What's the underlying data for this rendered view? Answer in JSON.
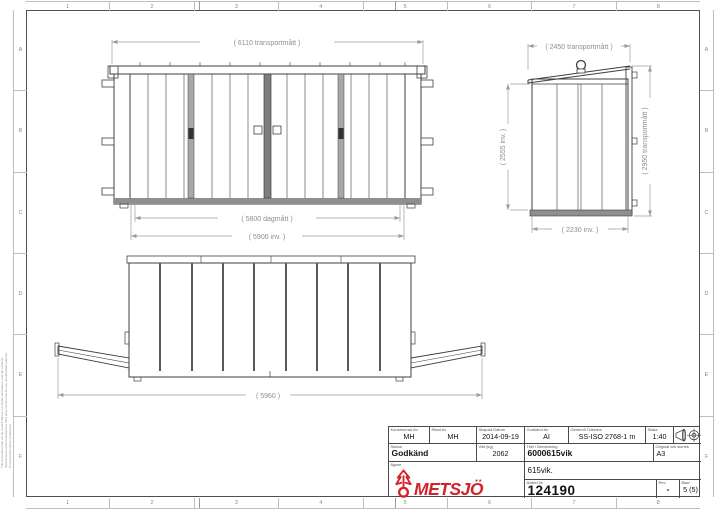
{
  "sheet": {
    "columns": [
      "1",
      "2",
      "3",
      "4",
      "5",
      "6",
      "7",
      "8"
    ],
    "rows": [
      "A",
      "B",
      "C",
      "D",
      "E",
      "F"
    ],
    "legal_notice": "This document must not be copied without our written permission, and the contents thereof must not be imparted to a third party nor be used for any unauthorized purpose. Contravention will be prosecuted."
  },
  "views": {
    "front": {
      "dim_transport": "( 6110 transportmått )",
      "dim_opening": "( 5800 dagmått )",
      "dim_inner": "( 5900 inv. )"
    },
    "side": {
      "dim_transport_width": "( 2450 transportmått )",
      "dim_inner_height": "( 2555 inv. )",
      "dim_transport_height": "( 2950 transportmått )",
      "dim_inner_width": "( 2230 inv. )"
    },
    "plan": {
      "dim_length": "( 5960 )"
    }
  },
  "title_block": {
    "designed_by": {
      "label": "Konstruerad Av",
      "value": "MH"
    },
    "drawn_by": {
      "label": "Ritad Av",
      "value": "MH"
    },
    "created_date": {
      "label": "Skapad Datum",
      "value": "2014-09-19"
    },
    "approved_by": {
      "label": "Godkänd Av",
      "value": "AI"
    },
    "general_tolerance": {
      "label": "Generell Tolerans",
      "value": "SS-ISO 2768-1 m"
    },
    "scale": {
      "label": "Skala",
      "value": "1:40"
    },
    "status": {
      "label": "Status",
      "value": "Godkänd"
    },
    "weight": {
      "label": "Vikt (kg)",
      "value": "2062"
    },
    "title": {
      "label": "Titel / Benämning",
      "value": "6000615vik",
      "subtitle": "615vik."
    },
    "sheet_size": {
      "label": "Original ark storlek",
      "value": "A3"
    },
    "owner": {
      "label": "Ägare"
    },
    "article_no": {
      "label": "Artikel Nr",
      "value": "124190"
    },
    "revision": {
      "label": "Rev",
      "value": "-"
    },
    "page": {
      "label": "Blad",
      "value": "5 (5)"
    }
  },
  "logo": {
    "name": "METSJÖ",
    "subtitle": "Ivarssons i Metsjö AB",
    "color": "#d2232a"
  },
  "colors": {
    "drawing_line": "#3f3f3f",
    "dimension": "#9b9b9b",
    "logo_red": "#d2232a"
  }
}
